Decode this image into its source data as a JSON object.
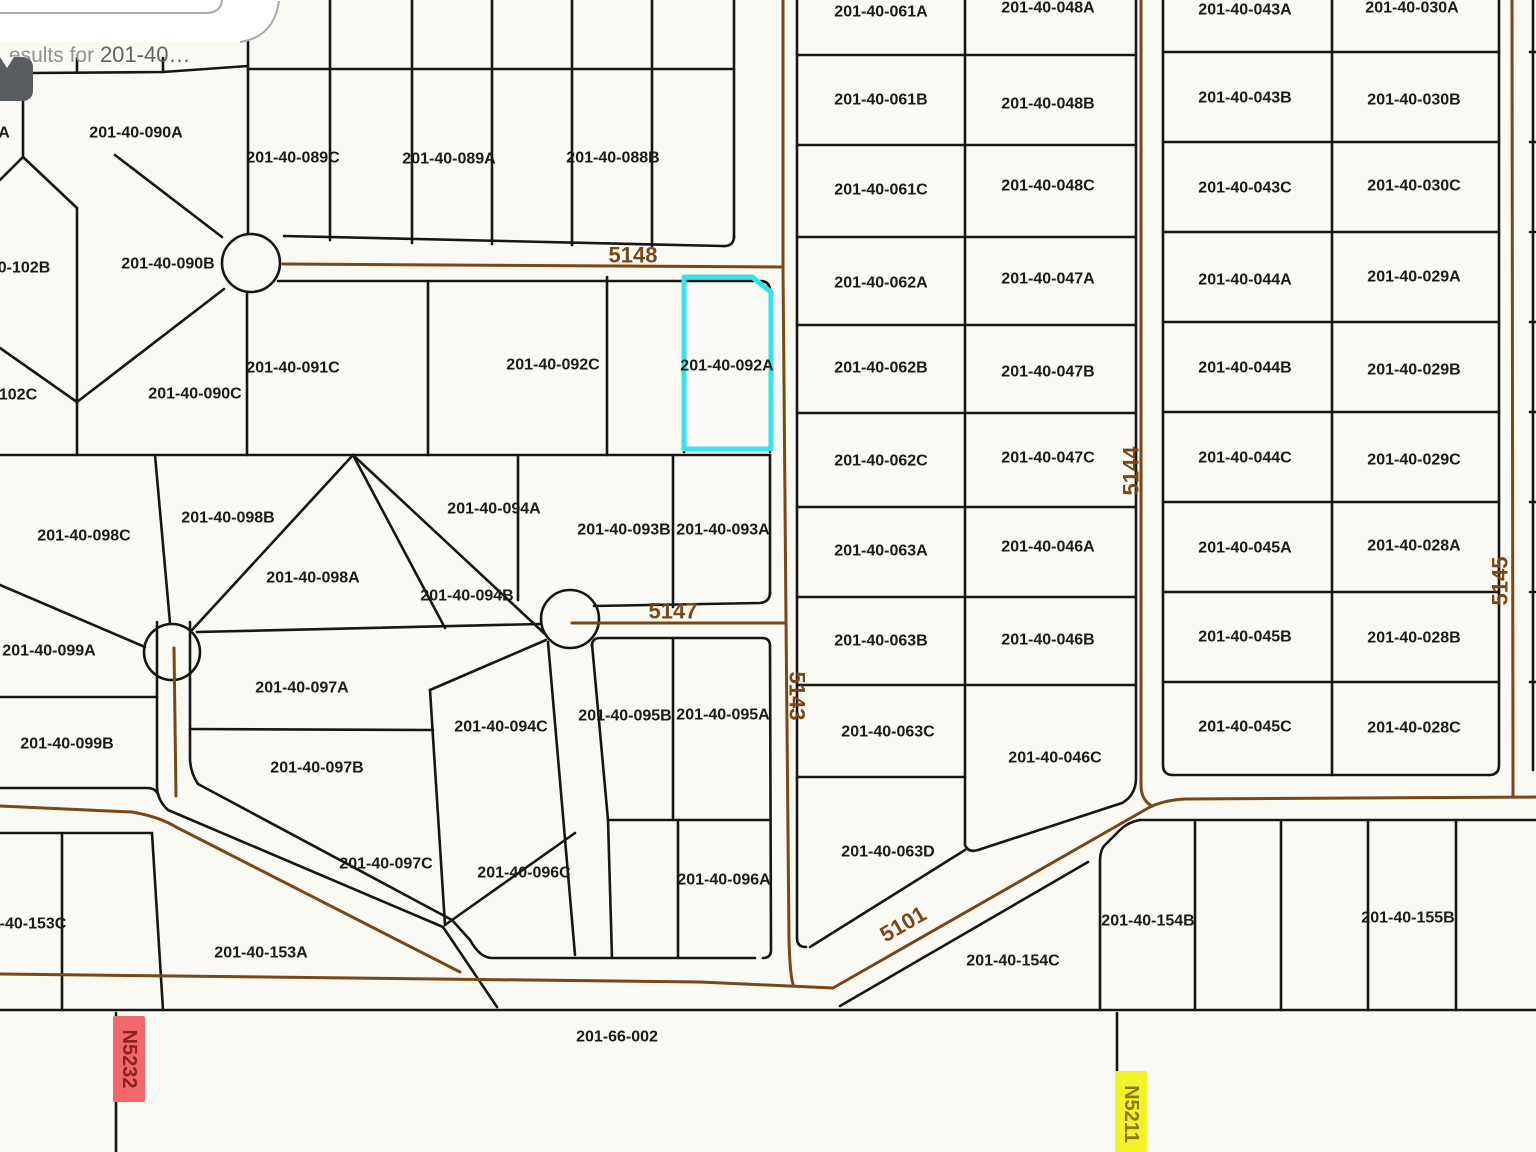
{
  "window": {
    "width": 1536,
    "height": 1152
  },
  "search_card": {
    "visible_text_prefix": "esults for ",
    "visible_query": "201-40…"
  },
  "map": {
    "background": "#FAF9F4",
    "line_color": "#161616",
    "road_color": "#7A4717",
    "road_label_color": "#7A4717",
    "parcel_label_color": "#1A1A1A",
    "highlight_color": "#35E3EA",
    "card_fill": "#FFFFFF",
    "card_border": "#A7AAAE",
    "selected_parcel": {
      "label": "201-40-092A",
      "path": "M684 277 L752 277 L771 292 L771 449 L684 449 Z"
    },
    "culdesacs": [
      {
        "cx": 251,
        "cy": 263,
        "r": 29
      },
      {
        "cx": 570,
        "cy": 619,
        "r": 29
      },
      {
        "cx": 172,
        "cy": 652,
        "r": 28
      }
    ],
    "boundary_paths": [
      "M33 73 L163 72 L248 66",
      "M77 58 L77 72",
      "M163 58 L163 72",
      "M222 0 L222 14",
      "M248 15 L248 234",
      "M330 0 L330 240",
      "M412 0 L412 243",
      "M492 0 L492 244",
      "M572 0 L572 245",
      "M652 0 L652 246",
      "M734 0 L734 238",
      "M248 69 L734 69",
      "M284 236 L722 246 Q734 247 734 236",
      "M278 281 L760 281 Q770 281 770 291 L770 452",
      "M247 292 L247 455",
      "M428 281 L428 455",
      "M607 277 L607 455",
      "M684 277 L684 452",
      "M23 101 L23 157 L0 180",
      "M23 157 L77 208",
      "M77 208 L77 455",
      "M115 155 L222 237",
      "M224 289 L77 402",
      "M77 402 L0 348",
      "M0 455 L770 455",
      "M155 455 L170 623",
      "M353 455 L546 635",
      "M353 455 L192 630",
      "M353 455 L445 628",
      "M197 632 L540 624",
      "M518 455 L518 600",
      "M673 455 L673 607",
      "M594 606 L760 603 Q770 602 770 592",
      "M770 455 L770 594",
      "M592 646 Q592 638 600 638 L762 638 Q770 638 770 646 L771 950 Q771 958 763 958",
      "M673 638 L673 820",
      "M608 820 L770 820",
      "M548 642 L575 955",
      "M592 644 L608 820 L612 958",
      "M678 820 L678 958",
      "M470 940 Q480 958 492 958 L755 958",
      "M190 622 L190 758 Q190 772 198 784 L452 920 L470 940",
      "M157 622 L157 786 Q157 800 168 810 L443 927 L497 1007",
      "M0 697 L157 697",
      "M0 585 L145 647",
      "M190 729 L433 730",
      "M546 640 L430 690",
      "M430 690 L445 925",
      "M575 833 L445 925",
      "M0 788 L147 788 Q157 788 159 797",
      "M0 833 L152 833",
      "M62 833 L62 1010",
      "M152 833 L163 1010",
      "M0 1010 L1536 1010",
      "M116 1013 L116 1152",
      "M1117 1013 L1117 1152",
      "M797 0 L797 938 Q797 947 806 947",
      "M965 0 L965 845",
      "M1136 0 L1136 778 Q1136 795 1122 803",
      "M1122 803 L978 850 Q968 853 965 845",
      "M965 850 L810 947",
      "M797 55 L1136 55",
      "M797 145 L1136 145",
      "M797 237 L1136 237",
      "M797 325 L1136 325",
      "M797 413 L1136 413",
      "M797 507 L1136 507",
      "M797 597 L1136 597",
      "M797 685 L1136 685",
      "M797 777 L965 777",
      "M1163 0 L1163 765 Q1163 775 1173 775",
      "M1499 0 L1499 765 Q1499 775 1489 775",
      "M1173 775 L1489 775",
      "M1332 0 L1332 775",
      "M1163 52 L1499 52",
      "M1163 142 L1499 142",
      "M1163 232 L1499 232",
      "M1163 322 L1499 322",
      "M1163 412 L1499 412",
      "M1163 502 L1499 502",
      "M1163 592 L1499 592",
      "M1163 682 L1499 682",
      "M1533 0 L1533 770",
      "M1530 52 L1536 52",
      "M1530 142 L1536 142",
      "M1530 232 L1536 232",
      "M1530 322 L1536 322",
      "M1530 412 L1536 412",
      "M1530 502 L1536 502",
      "M1530 592 L1536 592",
      "M1530 682 L1536 682",
      "M1140 820 L1536 820",
      "M1140 820 Q1128 822 1120 830 L1104 846 Q1100 851 1100 862 L1100 1010",
      "M1195 822 L1195 1010",
      "M1281 821 L1281 1010",
      "M1368 821 L1368 1010",
      "M1456 820 L1456 1010",
      "M840 1006 L1088 862"
    ],
    "road_paths": [
      "M283 264 L783 267",
      "M783 0 L783 266 L786 620 L789 940 Q790 975 793 984",
      "M572 623 L786 623",
      "M174 648 L176 796",
      "M0 806 L132 812 Q160 817 176 827 L460 972",
      "M0 974 L700 982 L833 988",
      "M833 988 L1150 807 Q1165 800 1185 799 L1536 797",
      "M1141 0 L1141 785 Q1141 800 1152 806",
      "M1512 0 L1513 797"
    ],
    "parcel_labels": [
      {
        "text": "A",
        "x": 4,
        "y": 133
      },
      {
        "text": "201-40-090A",
        "x": 136,
        "y": 133
      },
      {
        "text": "201-40-089C",
        "x": 293,
        "y": 158
      },
      {
        "text": "201-40-089A",
        "x": 449,
        "y": 159
      },
      {
        "text": "201-40-088B",
        "x": 613,
        "y": 158
      },
      {
        "text": "0-102B",
        "x": 24,
        "y": 268
      },
      {
        "text": "201-40-090B",
        "x": 168,
        "y": 264
      },
      {
        "text": "201-40-091C",
        "x": 293,
        "y": 368
      },
      {
        "text": "201-40-090C",
        "x": 195,
        "y": 394
      },
      {
        "text": "102C",
        "x": 18,
        "y": 395
      },
      {
        "text": "201-40-092C",
        "x": 553,
        "y": 365
      },
      {
        "text": "201-40-092A",
        "x": 727,
        "y": 366
      },
      {
        "text": "201-40-098C",
        "x": 84,
        "y": 536
      },
      {
        "text": "201-40-098B",
        "x": 228,
        "y": 518
      },
      {
        "text": "201-40-094A",
        "x": 494,
        "y": 509
      },
      {
        "text": "201-40-093B",
        "x": 624,
        "y": 530
      },
      {
        "text": "201-40-093A",
        "x": 723,
        "y": 530
      },
      {
        "text": "201-40-098A",
        "x": 313,
        "y": 578
      },
      {
        "text": "201-40-094B",
        "x": 467,
        "y": 596
      },
      {
        "text": "201-40-099A",
        "x": 49,
        "y": 651
      },
      {
        "text": "201-40-097A",
        "x": 302,
        "y": 688
      },
      {
        "text": "201-40-094C",
        "x": 501,
        "y": 727
      },
      {
        "text": "201-40-095B",
        "x": 625,
        "y": 716
      },
      {
        "text": "201-40-095A",
        "x": 723,
        "y": 715
      },
      {
        "text": "201-40-099B",
        "x": 67,
        "y": 744
      },
      {
        "text": "201-40-097B",
        "x": 317,
        "y": 768
      },
      {
        "text": "201-40-097C",
        "x": 386,
        "y": 864
      },
      {
        "text": "201-40-096C",
        "x": 524,
        "y": 873
      },
      {
        "text": "201-40-096A",
        "x": 724,
        "y": 880
      },
      {
        "text": "-40-153C",
        "x": 33,
        "y": 924
      },
      {
        "text": "201-40-153A",
        "x": 261,
        "y": 953
      },
      {
        "text": "201-66-002",
        "x": 617,
        "y": 1037
      },
      {
        "text": "201-40-063D",
        "x": 888,
        "y": 852
      },
      {
        "text": "201-40-154C",
        "x": 1013,
        "y": 961
      },
      {
        "text": "201-40-154B",
        "x": 1148,
        "y": 921
      },
      {
        "text": "201-40-155B",
        "x": 1408,
        "y": 918
      },
      {
        "text": "201-40-061A",
        "x": 881,
        "y": 12
      },
      {
        "text": "201-40-061B",
        "x": 881,
        "y": 100
      },
      {
        "text": "201-40-061C",
        "x": 881,
        "y": 190
      },
      {
        "text": "201-40-062A",
        "x": 881,
        "y": 283
      },
      {
        "text": "201-40-062B",
        "x": 881,
        "y": 368
      },
      {
        "text": "201-40-062C",
        "x": 881,
        "y": 461
      },
      {
        "text": "201-40-063A",
        "x": 881,
        "y": 551
      },
      {
        "text": "201-40-063B",
        "x": 881,
        "y": 641
      },
      {
        "text": "201-40-063C",
        "x": 888,
        "y": 732
      },
      {
        "text": "201-40-048A",
        "x": 1048,
        "y": 8
      },
      {
        "text": "201-40-048B",
        "x": 1048,
        "y": 104
      },
      {
        "text": "201-40-048C",
        "x": 1048,
        "y": 186
      },
      {
        "text": "201-40-047A",
        "x": 1048,
        "y": 279
      },
      {
        "text": "201-40-047B",
        "x": 1048,
        "y": 372
      },
      {
        "text": "201-40-047C",
        "x": 1048,
        "y": 458
      },
      {
        "text": "201-40-046A",
        "x": 1048,
        "y": 547
      },
      {
        "text": "201-40-046B",
        "x": 1048,
        "y": 640
      },
      {
        "text": "201-40-046C",
        "x": 1055,
        "y": 758
      },
      {
        "text": "201-40-043A",
        "x": 1245,
        "y": 10
      },
      {
        "text": "201-40-043B",
        "x": 1245,
        "y": 98
      },
      {
        "text": "201-40-043C",
        "x": 1245,
        "y": 188
      },
      {
        "text": "201-40-044A",
        "x": 1245,
        "y": 280
      },
      {
        "text": "201-40-044B",
        "x": 1245,
        "y": 368
      },
      {
        "text": "201-40-044C",
        "x": 1245,
        "y": 458
      },
      {
        "text": "201-40-045A",
        "x": 1245,
        "y": 548
      },
      {
        "text": "201-40-045B",
        "x": 1245,
        "y": 637
      },
      {
        "text": "201-40-045C",
        "x": 1245,
        "y": 727
      },
      {
        "text": "201-40-030A",
        "x": 1412,
        "y": 8
      },
      {
        "text": "201-40-030B",
        "x": 1414,
        "y": 100
      },
      {
        "text": "201-40-030C",
        "x": 1414,
        "y": 186
      },
      {
        "text": "201-40-029A",
        "x": 1414,
        "y": 277
      },
      {
        "text": "201-40-029B",
        "x": 1414,
        "y": 370
      },
      {
        "text": "201-40-029C",
        "x": 1414,
        "y": 460
      },
      {
        "text": "201-40-028A",
        "x": 1414,
        "y": 546
      },
      {
        "text": "201-40-028B",
        "x": 1414,
        "y": 638
      },
      {
        "text": "201-40-028C",
        "x": 1414,
        "y": 728
      }
    ],
    "road_labels": [
      {
        "text": "5148",
        "x": 633,
        "y": 255,
        "rotate": 0
      },
      {
        "text": "5147",
        "x": 673,
        "y": 611,
        "rotate": 0
      },
      {
        "text": "5143",
        "x": 797,
        "y": 696,
        "rotate": 90
      },
      {
        "text": "5144",
        "x": 1131,
        "y": 471,
        "rotate": -90
      },
      {
        "text": "5145",
        "x": 1500,
        "y": 581,
        "rotate": -90
      },
      {
        "text": "5101",
        "x": 903,
        "y": 924,
        "rotate": -30
      }
    ],
    "route_markers": [
      {
        "text": "N5232",
        "x": 129,
        "y": 1059,
        "rotate": 90,
        "bg": "#F2686B",
        "fg": "#8B2123"
      },
      {
        "text": "N5211",
        "x": 1131,
        "y": 1114,
        "rotate": 90,
        "bg": "#F3F228",
        "fg": "#837A07"
      }
    ],
    "card_shape": {
      "fill_path": "M0 0 L281 0 Q277 39 238 42 L0 42 Z",
      "stroke_paths": [
        "M0 13 L205 13 Q221 13 222 0",
        "M240 42 Q274 37 279 1"
      ]
    }
  }
}
